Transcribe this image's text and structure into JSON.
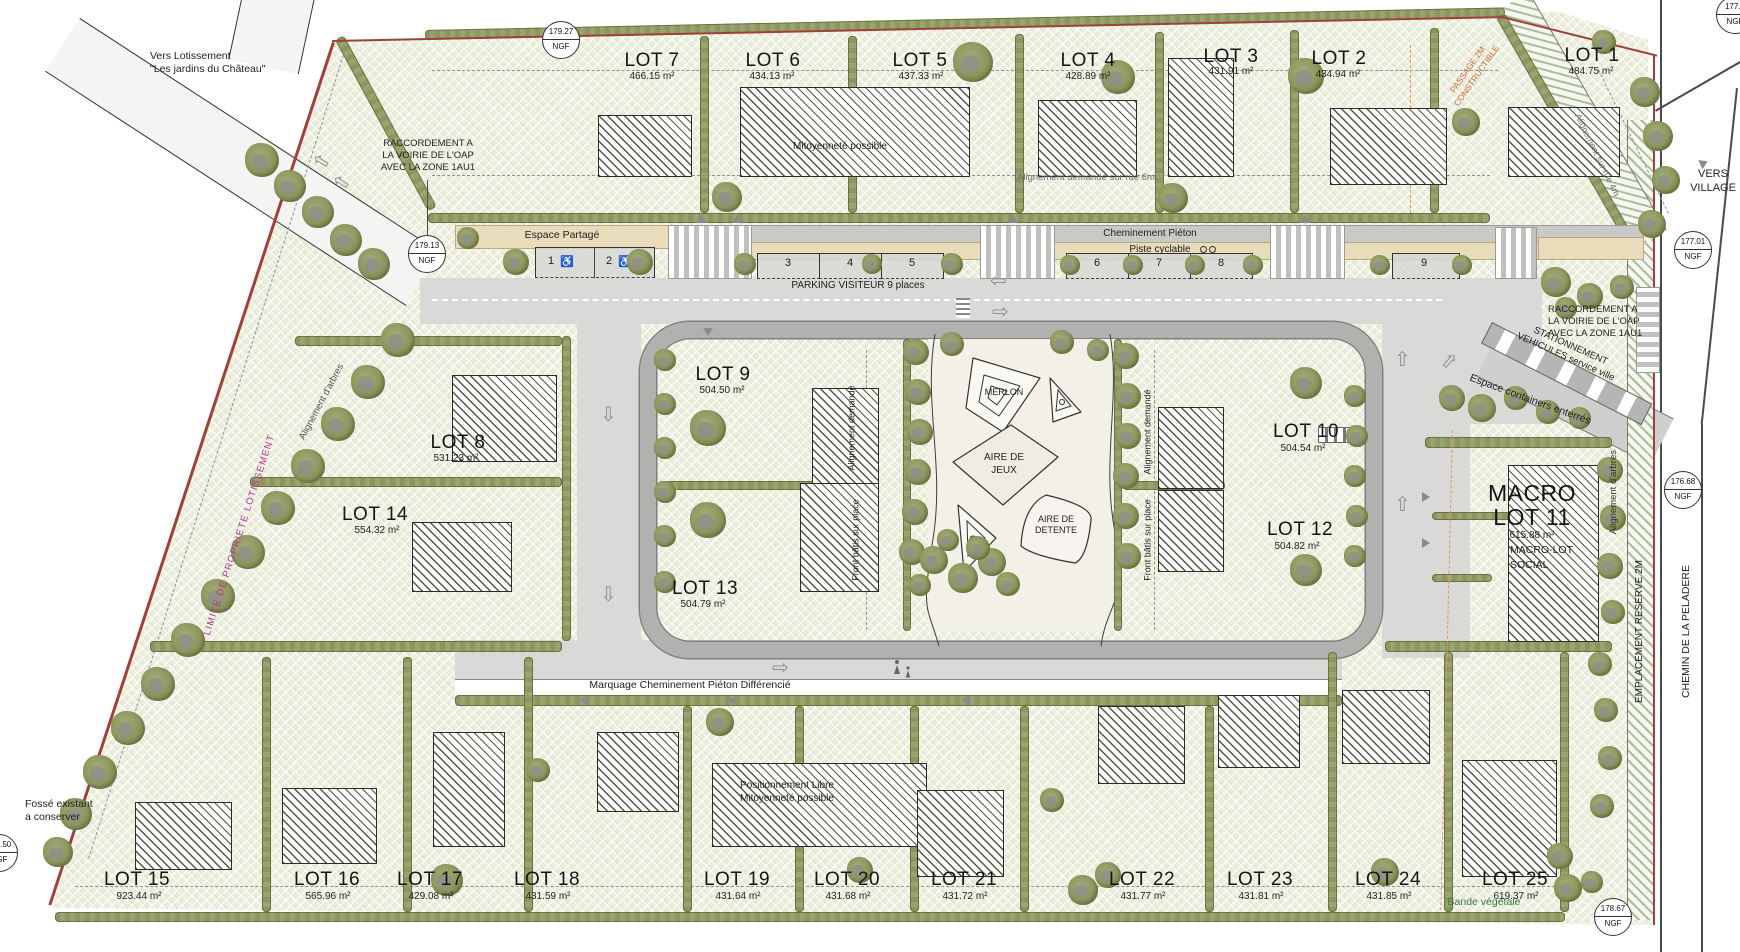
{
  "plan": {
    "lots": [
      {
        "name": "LOT 1",
        "area": "484.75 m²"
      },
      {
        "name": "LOT 2",
        "area": "434.94 m²"
      },
      {
        "name": "LOT 3",
        "area": "431.91 m²"
      },
      {
        "name": "LOT 4",
        "area": "428.89 m²"
      },
      {
        "name": "LOT 5",
        "area": "437.33 m²"
      },
      {
        "name": "LOT 6",
        "area": "434.13 m²"
      },
      {
        "name": "LOT 7",
        "area": "466.15 m²"
      },
      {
        "name": "LOT 8",
        "area": "531.23 m²"
      },
      {
        "name": "LOT 9",
        "area": "504.50 m²"
      },
      {
        "name": "LOT 10",
        "area": "504.54 m²"
      },
      {
        "name": "LOT 11",
        "area": "615.88 m²"
      },
      {
        "name": "LOT 12",
        "area": "504.82 m²"
      },
      {
        "name": "LOT 13",
        "area": "504.79 m²"
      },
      {
        "name": "LOT 14",
        "area": "554.32 m²"
      },
      {
        "name": "LOT 15",
        "area": "923.44 m²"
      },
      {
        "name": "LOT 16",
        "area": "565.96 m²"
      },
      {
        "name": "LOT 17",
        "area": "429.08 m²"
      },
      {
        "name": "LOT 18",
        "area": "431.59 m²"
      },
      {
        "name": "LOT 19",
        "area": "431.64 m²"
      },
      {
        "name": "LOT 20",
        "area": "431.68 m²"
      },
      {
        "name": "LOT 21",
        "area": "431.72 m²"
      },
      {
        "name": "LOT 22",
        "area": "431.77 m²"
      },
      {
        "name": "LOT 23",
        "area": "431.81 m²"
      },
      {
        "name": "LOT 24",
        "area": "431.85 m²"
      },
      {
        "name": "LOT 25",
        "area": "619.37 m²"
      }
    ],
    "macro_lot": {
      "prefix": "MACRO",
      "social1": "MACRO-LOT",
      "social2": "SOCIAL"
    },
    "parking": {
      "espace_partage": "Espace Partagé",
      "visiteur": "PARKING VISITEUR  9 places",
      "pieton": "Cheminement Piéton",
      "cyclable": "Piste cyclable",
      "bays": [
        "1",
        "2",
        "3",
        "4",
        "5",
        "6",
        "7",
        "8",
        "9"
      ],
      "accessible_icon": "♿"
    },
    "notes": {
      "vers_lotissement_1": "Vers Lotissement",
      "vers_lotissement_2": "\"Les jardins du Château\"",
      "raccordement_1": "RACCORDEMENT A",
      "raccordement_2": "LA VOIRIE DE L'OAP",
      "raccordement_3": "AVEC LA ZONE 1AU1",
      "mitoyennete": "Mitoyenneté possible",
      "alignement_rue6": "Alignement demandé sur rue 6m",
      "alignement_rue4": "Alignement sur rue 4m",
      "alignement_demande": "Alignement demandé",
      "front_batis": "Front bâtis sur place",
      "merlon": "MERLON",
      "aire_jeux_1": "AIRE DE",
      "aire_jeux_2": "JEUX",
      "aire_detente_1": "AIRE DE",
      "aire_detente_2": "DETENTE",
      "marquage": "Marquage Cheminement Piéton Différencié",
      "positionnement_1": "Positionnement Libre",
      "positionnement_2": "Mitoyenneté possible",
      "fosse_1": "Fossé existant",
      "fosse_2": "a conserver",
      "limite": "LIMITE DE PROPRIETE LOTISSEMENT",
      "alignement_arbres": "Alignement d'arbres",
      "espace_containers": "Espace containers enterrés",
      "stationnement_1": "STATIONNEMENT",
      "stationnement_2": "VEHICULES service ville",
      "emplacement_reserve": "EMPLACEMENT RESERVE 2M",
      "chemin": "CHEMIN DE LA PELADERE",
      "vers_village_1": "VERS",
      "vers_village_2": "VILLAGE",
      "bande_vegetale": "Bande végétale",
      "passage_1": "PASSAGE 2M",
      "passage_2": "CONSTRUCTIBLE"
    },
    "ngf": [
      {
        "value": "179.27",
        "unit": "NGF"
      },
      {
        "value": "179.13",
        "unit": "NGF"
      },
      {
        "value": "177.3",
        "unit": "NGF"
      },
      {
        "value": "177.01",
        "unit": "NGF"
      },
      {
        "value": "176.68",
        "unit": "NGF"
      },
      {
        "value": "178.67",
        "unit": "NGF"
      },
      {
        "value": "181.50",
        "unit": "NGF"
      }
    ],
    "icons": {
      "arrow_up": "⇧",
      "arrow_down": "⇩",
      "arrow_left": "⇦",
      "arrow_right": "⇨"
    },
    "colors": {
      "hedge": "#8d9660",
      "field": "#eaedda",
      "road": "#d9d9d8",
      "ring": "#b1b1af",
      "boundary": "#a04038",
      "limite": "#b0338f",
      "orange_dash": "#dc9a55",
      "beige": "#e9dcba"
    }
  },
  "decor": {
    "trees": [
      [
        262,
        160,
        34
      ],
      [
        290,
        186,
        32
      ],
      [
        318,
        212,
        32
      ],
      [
        346,
        240,
        32
      ],
      [
        374,
        264,
        32
      ],
      [
        398,
        340,
        34
      ],
      [
        368,
        382,
        34
      ],
      [
        338,
        424,
        34
      ],
      [
        308,
        466,
        34
      ],
      [
        278,
        508,
        34
      ],
      [
        248,
        552,
        34
      ],
      [
        218,
        596,
        34
      ],
      [
        188,
        640,
        34
      ],
      [
        158,
        684,
        34
      ],
      [
        128,
        728,
        34
      ],
      [
        100,
        772,
        34
      ],
      [
        76,
        814,
        32
      ],
      [
        58,
        852,
        30
      ],
      [
        727,
        197,
        30
      ],
      [
        973,
        62,
        40
      ],
      [
        1118,
        77,
        34
      ],
      [
        1306,
        76,
        36
      ],
      [
        1173,
        198,
        30
      ],
      [
        1466,
        122,
        28
      ],
      [
        1645,
        92,
        30
      ],
      [
        1658,
        136,
        30
      ],
      [
        1666,
        180,
        28
      ],
      [
        1652,
        224,
        28
      ],
      [
        1604,
        42,
        24
      ],
      [
        468,
        238,
        22
      ],
      [
        516,
        262,
        26
      ],
      [
        640,
        262,
        26
      ],
      [
        745,
        264,
        22
      ],
      [
        872,
        264,
        20
      ],
      [
        952,
        264,
        22
      ],
      [
        1070,
        265,
        20
      ],
      [
        1133,
        265,
        20
      ],
      [
        1195,
        265,
        20
      ],
      [
        1253,
        265,
        20
      ],
      [
        1380,
        265,
        20
      ],
      [
        1462,
        265,
        20
      ],
      [
        1556,
        282,
        30
      ],
      [
        1590,
        296,
        26
      ],
      [
        1622,
        287,
        24
      ],
      [
        1566,
        308,
        22
      ],
      [
        665,
        360,
        22
      ],
      [
        665,
        404,
        22
      ],
      [
        665,
        448,
        22
      ],
      [
        665,
        492,
        22
      ],
      [
        665,
        536,
        22
      ],
      [
        665,
        582,
        22
      ],
      [
        708,
        428,
        36
      ],
      [
        708,
        520,
        36
      ],
      [
        916,
        352,
        26
      ],
      [
        918,
        392,
        26
      ],
      [
        920,
        432,
        26
      ],
      [
        918,
        472,
        26
      ],
      [
        915,
        512,
        26
      ],
      [
        912,
        552,
        26
      ],
      [
        1126,
        356,
        26
      ],
      [
        1128,
        396,
        26
      ],
      [
        1128,
        436,
        26
      ],
      [
        1126,
        476,
        26
      ],
      [
        1126,
        516,
        26
      ],
      [
        1128,
        556,
        26
      ],
      [
        952,
        344,
        24
      ],
      [
        1062,
        342,
        24
      ],
      [
        1098,
        350,
        22
      ],
      [
        934,
        560,
        28
      ],
      [
        963,
        578,
        30
      ],
      [
        992,
        562,
        28
      ],
      [
        948,
        540,
        22
      ],
      [
        978,
        548,
        24
      ],
      [
        1008,
        584,
        24
      ],
      [
        920,
        585,
        22
      ],
      [
        1306,
        383,
        32
      ],
      [
        1306,
        570,
        32
      ],
      [
        1355,
        396,
        22
      ],
      [
        1357,
        436,
        22
      ],
      [
        1355,
        476,
        22
      ],
      [
        1357,
        516,
        22
      ],
      [
        1355,
        556,
        22
      ],
      [
        1452,
        398,
        26
      ],
      [
        1482,
        408,
        28
      ],
      [
        1516,
        398,
        24
      ],
      [
        1548,
        412,
        24
      ],
      [
        1580,
        418,
        22
      ],
      [
        1610,
        470,
        26
      ],
      [
        1613,
        518,
        26
      ],
      [
        1610,
        566,
        26
      ],
      [
        1613,
        612,
        24
      ],
      [
        1600,
        664,
        24
      ],
      [
        1606,
        710,
        24
      ],
      [
        1610,
        758,
        24
      ],
      [
        1602,
        806,
        24
      ],
      [
        1560,
        856,
        26
      ],
      [
        1592,
        882,
        22
      ],
      [
        720,
        722,
        28
      ],
      [
        538,
        770,
        24
      ],
      [
        447,
        880,
        32
      ],
      [
        860,
        870,
        26
      ],
      [
        1052,
        800,
        24
      ],
      [
        1083,
        890,
        30
      ],
      [
        1108,
        875,
        26
      ],
      [
        1385,
        872,
        28
      ],
      [
        1568,
        888,
        28
      ]
    ]
  }
}
